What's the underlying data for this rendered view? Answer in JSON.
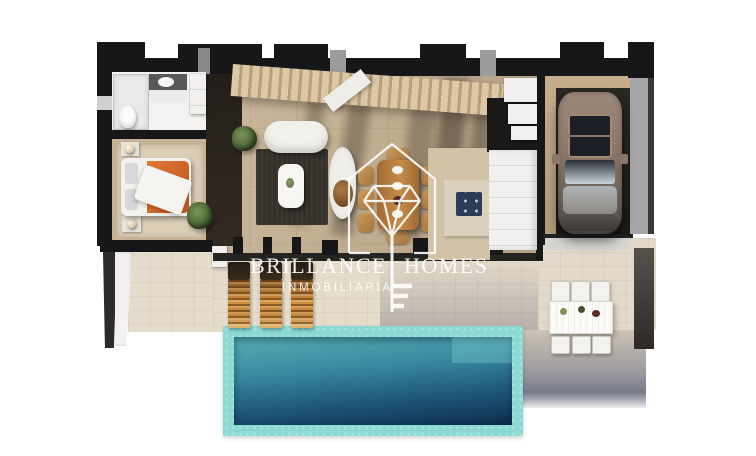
{
  "watermark": {
    "brand_word1": "BRILLANCE",
    "brand_word2": "HOMES",
    "subtitle": "INMOBILIARIA",
    "logo_icon": "house-diamond-key-logo",
    "color": "#ffffff"
  },
  "palette": {
    "background": "#ffffff",
    "wall_dark": "#17171a",
    "interior_floor": "#c6b296",
    "terrace_tile": "#e6dccb",
    "pool_coping": "#8bd9d2",
    "pool_water_top": "#55aeb2",
    "pool_water_bottom": "#0e2c4d",
    "stair_wood": "#dcc7a6",
    "living_rug": "#35302a",
    "bed_blanket_accent": "#d2622a",
    "dining_wood": "#b5793c",
    "lounger_wood": "#d2923e",
    "cooktop_navy": "#2c3c55",
    "car_body": "#8d7868",
    "garage_floor": "#23201d"
  }
}
